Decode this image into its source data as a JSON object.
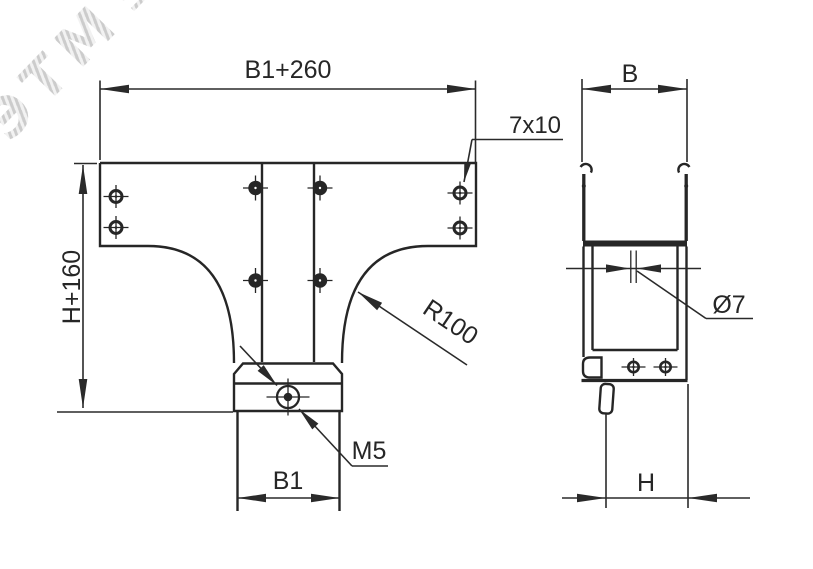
{
  "colors": {
    "line": "#262626",
    "dimension": "#2a2a2a",
    "watermark": "#d3d3d3",
    "background": "#ffffff"
  },
  "watermark": {
    "text": "ЭТМ",
    "logo_icon": "☰"
  },
  "front_view": {
    "labels": {
      "top_width": "B1+260",
      "left_height": "H+160",
      "slot_size": "7x10",
      "fillet_radius": "R100",
      "thread_size": "M5",
      "bottom_width": "B1"
    }
  },
  "side_view": {
    "labels": {
      "top_width": "B",
      "hole_diameter": "Ø7",
      "bottom_height": "H"
    }
  }
}
